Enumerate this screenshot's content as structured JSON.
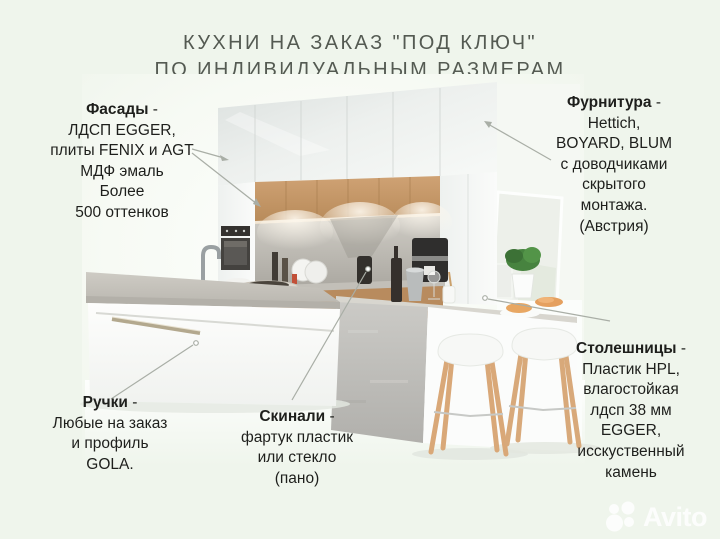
{
  "title": {
    "line1": "КУХНИ НА ЗАКАЗ \"ПОД КЛЮЧ\"",
    "line2": "ПО ИНДИВИДУАЛЬНЫМ РАЗМЕРАМ"
  },
  "annotations": {
    "facades": {
      "term": "Фасады",
      "suffix": " -",
      "lines": [
        "ЛДСП EGGER,",
        "плиты FENIX и AGT",
        "МДФ эмаль",
        "Более",
        "500 оттенков"
      ]
    },
    "furniture": {
      "term": "Фурнитура",
      "suffix": " -",
      "lines": [
        "Hettich,",
        "BOYARD, BLUM",
        "с доводчиками",
        "скрытого",
        "монтажа.",
        "(Австрия)"
      ]
    },
    "handles": {
      "term": "Ручки",
      "suffix": " -",
      "lines": [
        "Любые на заказ",
        "и профиль",
        "GOLA."
      ]
    },
    "skinali": {
      "term": "Скинали",
      "suffix": " -",
      "lines": [
        "фартук пластик",
        "или стекло",
        "(пано)"
      ]
    },
    "countertops": {
      "term": "Столешницы",
      "suffix": " -",
      "lines": [
        "Пластик HPL,",
        "влагостойкая",
        "лдсп 38 мм",
        "EGGER,",
        "исскуственный",
        "камень"
      ]
    }
  },
  "watermark": {
    "brand": "Avito"
  },
  "colors": {
    "page_background": "#eff5ec",
    "title_text": "#545a52",
    "body_text": "#1e1f1c",
    "wood_accent": "#c59a6b",
    "concrete": "#b9b7b1",
    "leader_line": "#a9aea6",
    "watermark": "#ffffff"
  }
}
